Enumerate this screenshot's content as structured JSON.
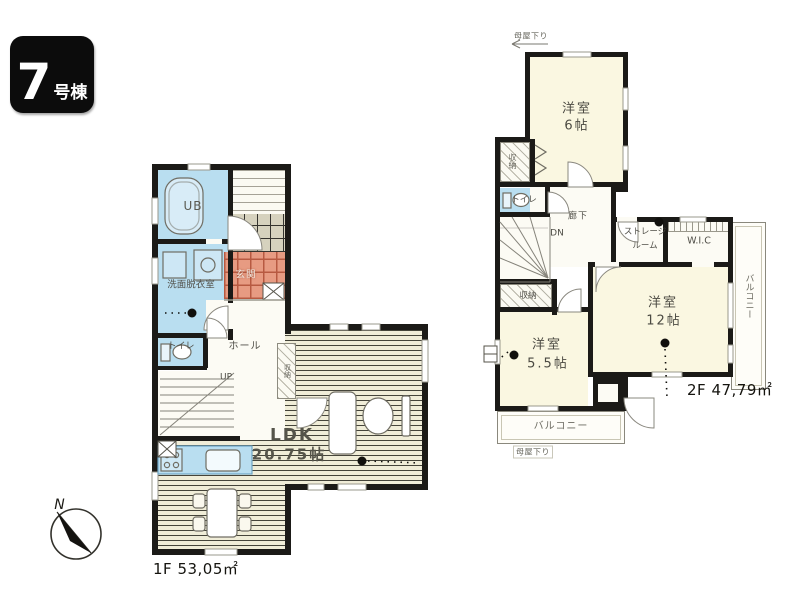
{
  "badge": {
    "number": "7",
    "suffix": "号棟"
  },
  "compass": {
    "label": "N"
  },
  "palette": {
    "wall": "#1b1a17",
    "wet_room_blue": "#b9def0",
    "entry_tile_orange": "#e79b82",
    "wood_floor": "#f0edd8",
    "tatami_cream": "#faf7e1",
    "badge_black": "#0c0c0c"
  },
  "floor1": {
    "area_label": "1F 53,05㎡",
    "rooms": {
      "ub": "UB",
      "washroom": "洗面脱衣室",
      "toilet": "トイレ",
      "entrance": "玄関",
      "hall": "ホール",
      "stairs_up": "UP",
      "closet": "収納",
      "ldk_line1": "LDK",
      "ldk_line2": "20.75帖"
    }
  },
  "floor2": {
    "area_label": "2F 47,79㎡",
    "note_top": "母屋下り",
    "note_bottom": "母屋下り",
    "rooms": {
      "bedroom6_line1": "洋室",
      "bedroom6_line2": "6帖",
      "closet_top": "収納",
      "toilet": "トイレ",
      "hallway": "廊下",
      "stairs_dn": "DN",
      "closet_mid": "収納",
      "storage_line1": "ストレージ",
      "storage_line2": "ルーム",
      "wic": "W.I.C",
      "bedroom12_line1": "洋室",
      "bedroom12_line2": "12帖",
      "bedroom55_line1": "洋室",
      "bedroom55_line2": "5.5帖",
      "balcony_right": "バルコニー",
      "balcony_bottom": "バルコニー"
    }
  }
}
